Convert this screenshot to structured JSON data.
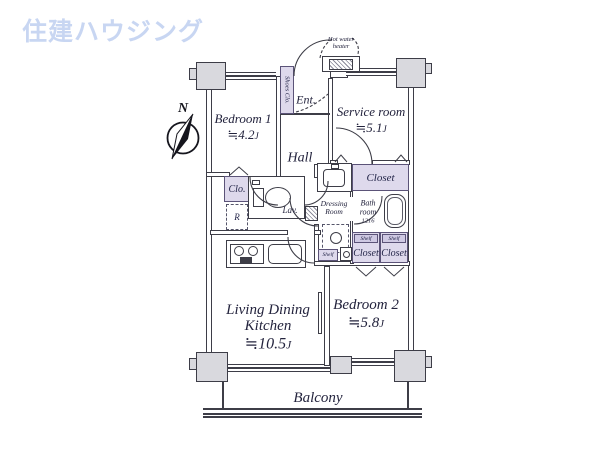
{
  "logo": {
    "text": "住建ハウジング"
  },
  "compass": {
    "north": "N"
  },
  "rooms": {
    "bedroom1": {
      "name": "Bedroom 1",
      "area": "≒4.2",
      "unit": "J"
    },
    "service_room": {
      "name": "Service room",
      "area": "≒5.1",
      "unit": "J"
    },
    "living_dining_kitchen": {
      "name_line1": "Living Dining",
      "name_line2": "Kitchen",
      "area": "≒10.5",
      "unit": "J"
    },
    "bedroom2": {
      "name": "Bedroom 2",
      "area": "≒5.8",
      "unit": "J"
    },
    "hall": {
      "name": "Hall"
    },
    "entrance": {
      "name": "Ent."
    },
    "balcony": {
      "name": "Balcony"
    },
    "bathroom": {
      "name_line1": "Bath",
      "name_line2": "room",
      "size": "1216"
    },
    "dressing_room": {
      "name_line1": "Dressing",
      "name_line2": "Room"
    },
    "lavatory": {
      "name": "Lav."
    }
  },
  "storage": {
    "shoes_closet": "Shoes Clo.",
    "closet": "Clo.",
    "service_closet": "Closet",
    "bedroom2_closet_left": "Closet",
    "bedroom2_closet_right": "Closet",
    "shelf": "Shelf",
    "shelf_b2_left": "Shelf",
    "shelf_b2_right": "Shelf"
  },
  "equipment": {
    "refrigerator": "R",
    "hot_water_heater_line1": "Hot water",
    "hot_water_heater_line2": "heater"
  },
  "colors": {
    "logo_blue": "#c8d6f2",
    "closet_purple": "#ded9ec",
    "wall_dark": "#3d3d47"
  }
}
